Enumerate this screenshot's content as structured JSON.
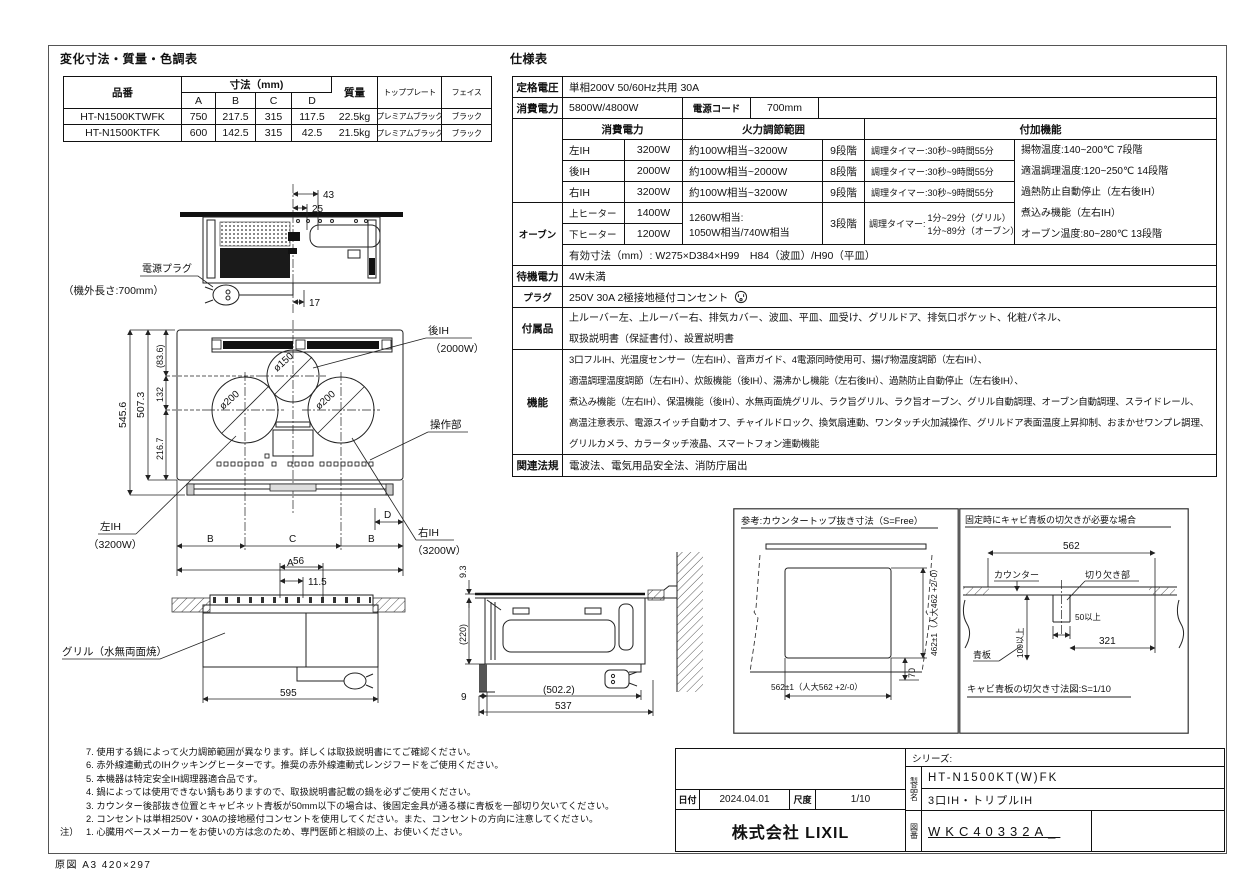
{
  "sheet": {
    "origin_note": "原図  A3 420×297"
  },
  "dimension_table": {
    "title": "変化寸法・質量・色調表",
    "headers": {
      "part_no": "品番",
      "dims_group": "寸法（mm)",
      "col_a": "A",
      "col_b": "B",
      "col_c": "C",
      "col_d": "D",
      "mass": "質量",
      "top_plate": "トッププレート",
      "face": "フェイス"
    },
    "rows": [
      {
        "part_no": "HT-N1500KTWFK",
        "a": "750",
        "b": "217.5",
        "c": "315",
        "d": "117.5",
        "mass": "22.5kg",
        "top_plate": "プレミアムブラック",
        "face": "ブラック"
      },
      {
        "part_no": "HT-N1500KTFK",
        "a": "600",
        "b": "142.5",
        "c": "315",
        "d": "42.5",
        "mass": "21.5kg",
        "top_plate": "プレミアムブラック",
        "face": "ブラック"
      }
    ]
  },
  "spec_table": {
    "title": "仕様表",
    "rated_voltage_label": "定格電圧",
    "rated_voltage": "単相200V  50/60Hz共用  30A",
    "power_label": "消費電力",
    "power": "5800W/4800W",
    "cord_label": "電源コード",
    "cord": "700mm",
    "sub_headers": {
      "power": "消費電力",
      "range": "火力調節範囲",
      "extra": "付加機能"
    },
    "burners": [
      {
        "name": "左IH",
        "watt": "3200W",
        "range": "約100W相当~3200W",
        "steps": "9段階",
        "timer": "調理タイマー:30秒~9時間55分"
      },
      {
        "name": "後IH",
        "watt": "2000W",
        "range": "約100W相当~2000W",
        "steps": "8段階",
        "timer": "調理タイマー:30秒~9時間55分"
      },
      {
        "name": "右IH",
        "watt": "3200W",
        "range": "約100W相当~3200W",
        "steps": "9段階",
        "timer": "調理タイマー:30秒~9時間55分"
      }
    ],
    "oven": {
      "label": "オーブン",
      "upper_label": "上ヒーター",
      "upper_watt": "1400W",
      "lower_label": "下ヒーター",
      "lower_watt": "1200W",
      "range_line1": "1260W相当:",
      "range_line2": "1050W相当/740W相当",
      "steps": "3段階",
      "timer_prefix": "調理タイマー:",
      "timer_line1": "1分~29分（グリル）",
      "timer_line2": "1分~89分（オーブン）",
      "inner_dims": "有効寸法（mm）:  W275×D384×H99　H84（波皿）/H90（平皿）"
    },
    "extra_functions": [
      "揚物温度:140~200℃  7段階",
      "適温調理温度:120~250℃  14段階",
      "過熱防止自動停止（左右後IH）",
      "煮込み機能（左右IH）",
      "オーブン温度:80~280℃  13段階"
    ],
    "standby_label": "待機電力",
    "standby": "4W未満",
    "plug_label": "プラグ",
    "plug": "250V 30A 2極接地極付コンセント",
    "accessories_label": "付属品",
    "accessories_line1": "上ルーバー左、上ルーバー右、排気カバー、波皿、平皿、皿受け、グリルドア、排気口ポケット、化粧パネル、",
    "accessories_line2": "取扱説明書（保証書付）、設置説明書",
    "functions_label": "機能",
    "functions_lines": [
      "3口フルIH、光温度センサー（左右IH）、音声ガイド、4電源同時使用可、揚げ物温度調節（左右IH）、",
      "適温調理温度調節（左右IH）、炊飯機能（後IH）、湯沸かし機能（左右後IH）、過熱防止自動停止（左右後IH）、",
      "煮込み機能（左右IH）、保温機能（後IH）、水無両面焼グリル、ラク旨グリル、ラク旨オーブン、グリル自動調理、オーブン自動調理、スライドレール、",
      "高温注意表示、電源スイッチ自動オフ、チャイルドロック、換気扇連動、ワンタッチ火加減操作、グリルドア表面温度上昇抑制、おまかせワンプレ調理、",
      "グリルカメラ、カラータッチ液晶、スマートフォン連動機能"
    ],
    "laws_label": "関連法規",
    "laws": "電波法、電気用品安全法、消防庁届出"
  },
  "diagrams": {
    "bottom_view": {
      "dim_43": "43",
      "dim_25": "25",
      "dim_17": "17",
      "plug_label": "電源プラグ",
      "plug_note": "（機外長さ:700mm）"
    },
    "top_view": {
      "dim_total_depth": "545.6",
      "dim_plate_depth": "507.3",
      "dim_back": "(83.6)",
      "dim_mid": "132",
      "dim_front": "216.7",
      "circle_back": "ø150",
      "circle_left": "ø200",
      "circle_right": "ø200",
      "label_back": "後IH",
      "label_back_watt": "（2000W）",
      "label_panel": "操作部",
      "label_left": "左IH",
      "label_left_watt": "（3200W）",
      "label_right": "右IH",
      "label_right_watt": "（3200W）",
      "dim_b1": "B",
      "dim_c": "C",
      "dim_b2": "B",
      "dim_d": "D",
      "dim_a": "A"
    },
    "front_view": {
      "dim_56": "56",
      "dim_115": "11.5",
      "dim_595": "595",
      "label_grill": "グリル（水無両面焼）"
    },
    "side_view": {
      "dim_93": "9.3",
      "dim_220": "(220)",
      "dim_9": "9",
      "dim_5022": "(502.2)",
      "dim_537": "537"
    },
    "cutout_box": {
      "title": "参考:カウンタートップ抜き寸法（S=Free）",
      "dim_width": "562±1（人大562 +2/-0）",
      "dim_height": "462±1（人大462 +2/-0）",
      "dim_70": "70"
    },
    "backboard_box": {
      "title": "固定時にキャビ青板の切欠きが必要な場合",
      "dim_562": "562",
      "label_counter": "カウンター",
      "label_notch": "切り欠き部",
      "dim_50": "50以上",
      "dim_321": "321",
      "dim_100": "100以上",
      "label_board": "青板",
      "caption": "キャビ青板の切欠き寸法図:S=1/10"
    }
  },
  "notes": {
    "prefix": "注）",
    "lines": [
      "7. 使用する鍋によって火力調節範囲が異なります。詳しくは取扱説明書にてご確認ください。",
      "6. 赤外線連動式のIHクッキングヒーターです。推奨の赤外線連動式レンジフードをご使用ください。",
      "5. 本機器は特定安全IH調理器適合品です。",
      "4. 鍋によっては使用できない鍋もありますので、取扱説明書記載の鍋を必ずご使用ください。",
      "3. カウンター後部抜き位置とキャビネット青板が50mm以下の場合は、後固定金具が通る様に青板を一部切り欠いてください。",
      "2. コンセントは単相250V・30Aの接地極付コンセントを使用してください。また、コンセントの方向に注意してください。",
      "1. 心臓用ペースメーカーをお使いの方は念のため、専門医師と相談の上、お使いください。"
    ]
  },
  "title_block": {
    "date_label": "日付",
    "date": "2024.04.01",
    "scale_label": "尺度",
    "scale": "1/10",
    "company": "株式会社 LIXIL",
    "series_label": "シリーズ:",
    "product_label": "製品名",
    "product_line1": "HT-N1500KT(W)FK",
    "product_line2": "3口IH・トリプルIH",
    "drawing_no_label": "図番",
    "drawing_no": "WKC40332A_"
  }
}
